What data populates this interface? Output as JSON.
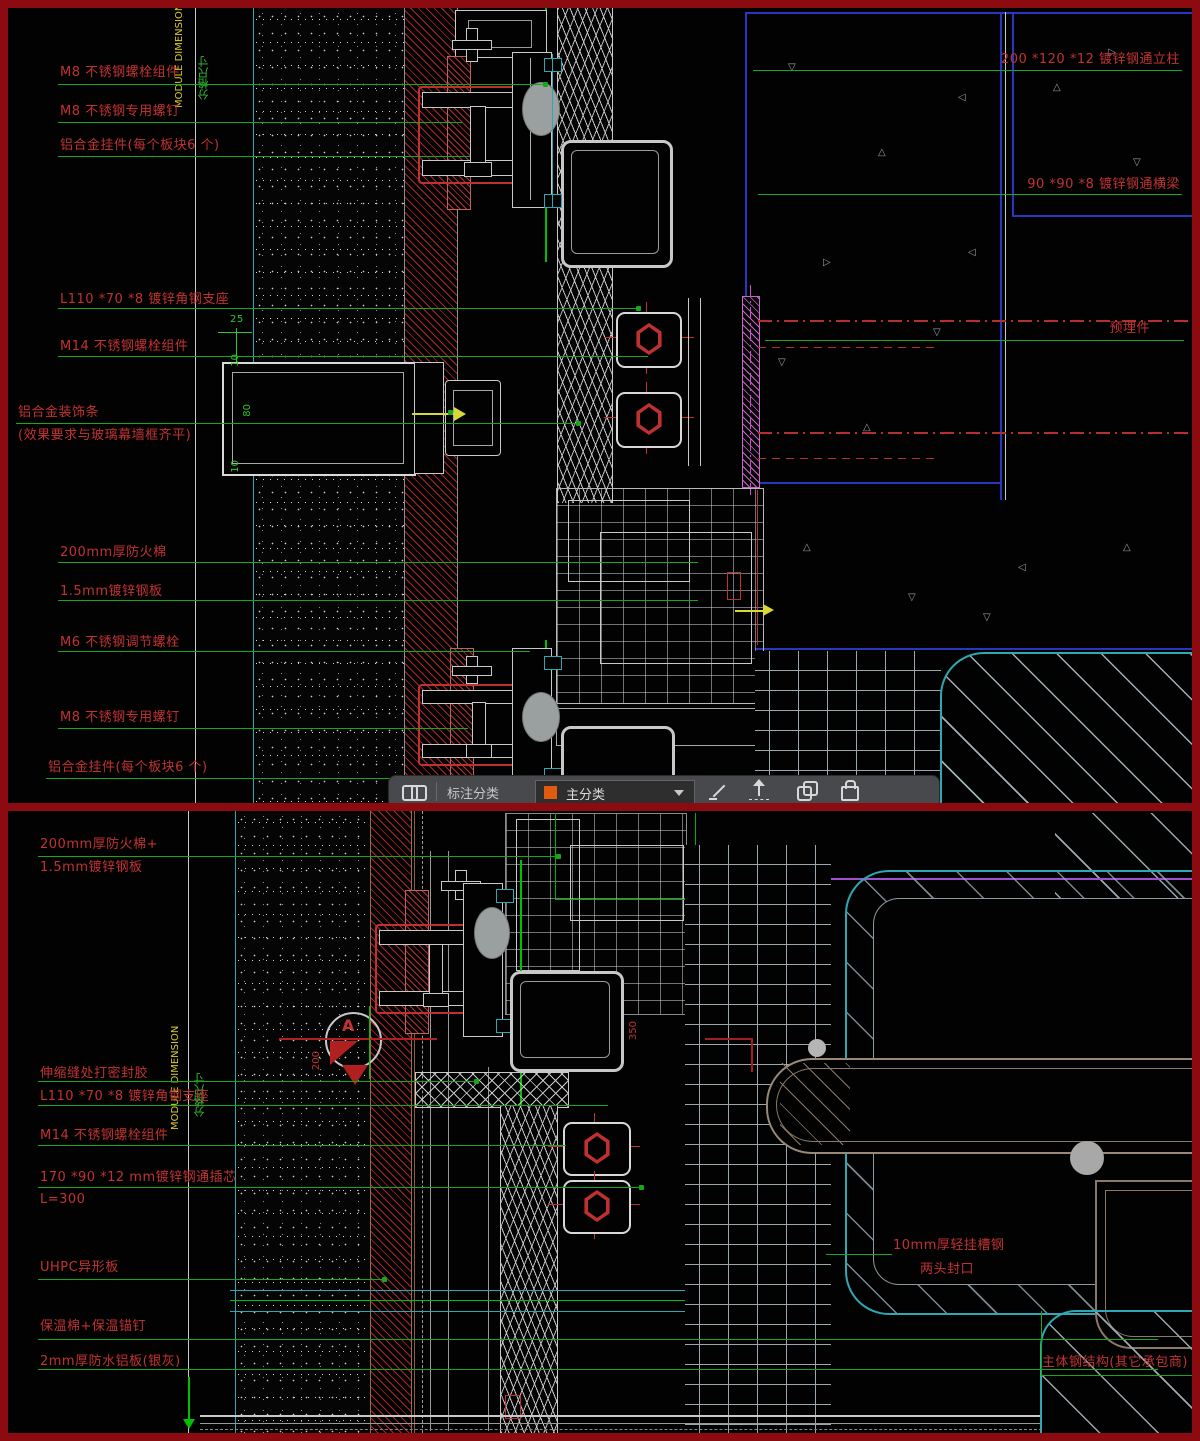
{
  "app": {
    "frame_color": "#8c0b10"
  },
  "toolbar": {
    "annotation_category_label": "标注分类",
    "category_value": "主分类"
  },
  "top_panel": {
    "module_dimension_label": "MODULE DIMENSION",
    "grid_dimension_label": "分格尺寸",
    "left_labels": [
      "M8 不锈钢螺栓组件",
      "M8 不锈钢专用螺钉",
      "铝合金挂件(每个板块6 个)",
      "L110 *70 *8 镀锌角钢支座",
      "M14 不锈钢螺栓组件",
      "铝合金装饰条",
      "(效果要求与玻璃幕墙框齐平)",
      "200mm厚防火棉",
      "1.5mm镀锌钢板",
      "M6 不锈钢调节螺栓",
      "M8 不锈钢专用螺钉",
      "铝合金挂件(每个板块6 个)"
    ],
    "right_labels": [
      "200 *120 *12 镀锌钢通立柱",
      "90 *90 *8 镀锌钢通横梁",
      "预埋件"
    ],
    "dims": [
      "25",
      "10",
      "80",
      "10"
    ]
  },
  "bottom_panel": {
    "module_dimension_label": "MODULE DIMENSION",
    "grid_dimension_label": "分格尺寸",
    "left_labels": [
      "200mm厚防火棉+",
      "1.5mm镀锌钢板",
      "伸缩缝处打密封胶",
      "L110 *70 *8 镀锌角钢支座",
      "M14 不锈钢螺栓组件",
      "170 *90 *12 mm镀锌钢通插芯",
      "L=300",
      "UHPC异形板",
      "保温棉+保温锚钉",
      "2mm厚防水铝板(银灰)"
    ],
    "right_labels": [
      "10mm厚轻挂槽钢",
      "两头封口",
      "主体钢结构(其它承包商)"
    ],
    "callout": "A",
    "dims": [
      "200",
      "350"
    ]
  }
}
